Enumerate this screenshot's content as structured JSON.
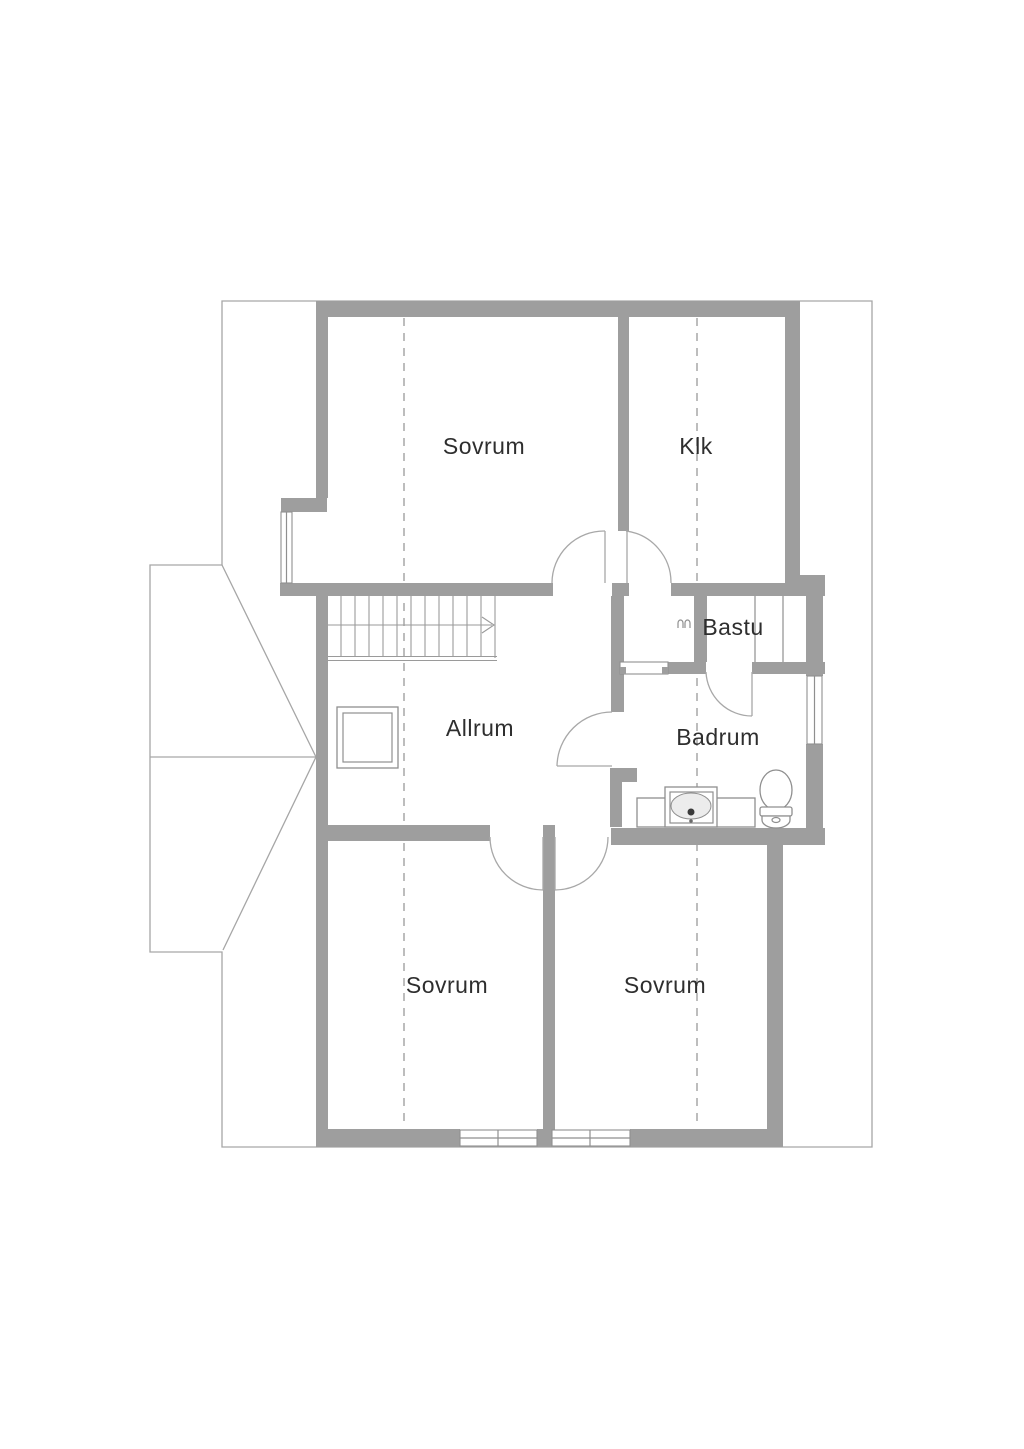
{
  "plan": {
    "type": "floor-plan",
    "rooms": [
      {
        "id": "sovrum-top",
        "label": "Sovrum"
      },
      {
        "id": "klk",
        "label": "Klk"
      },
      {
        "id": "bastu",
        "label": "Bastu"
      },
      {
        "id": "allrum",
        "label": "Allrum"
      },
      {
        "id": "badrum",
        "label": "Badrum"
      },
      {
        "id": "sovrum-bottom-left",
        "label": "Sovrum"
      },
      {
        "id": "sovrum-bottom-right",
        "label": "Sovrum"
      }
    ],
    "fixtures": [
      "stairs-up-icon",
      "chimney-icon",
      "sink-icon",
      "toilet-icon",
      "sauna-benches",
      "sauna-heater-icon"
    ],
    "windows_count": 4,
    "doors_count": 6
  },
  "colors": {
    "background": "#ffffff",
    "wall": "#9e9e9e",
    "line": "#8f8f8f",
    "thin_outline": "#a6a6a6",
    "door_arc": "#a8a8a8",
    "dashed": "#bdbdbd",
    "fixture": "#8f8f8f",
    "stair": "#9a9a9a",
    "label": "#2e2e2e"
  }
}
